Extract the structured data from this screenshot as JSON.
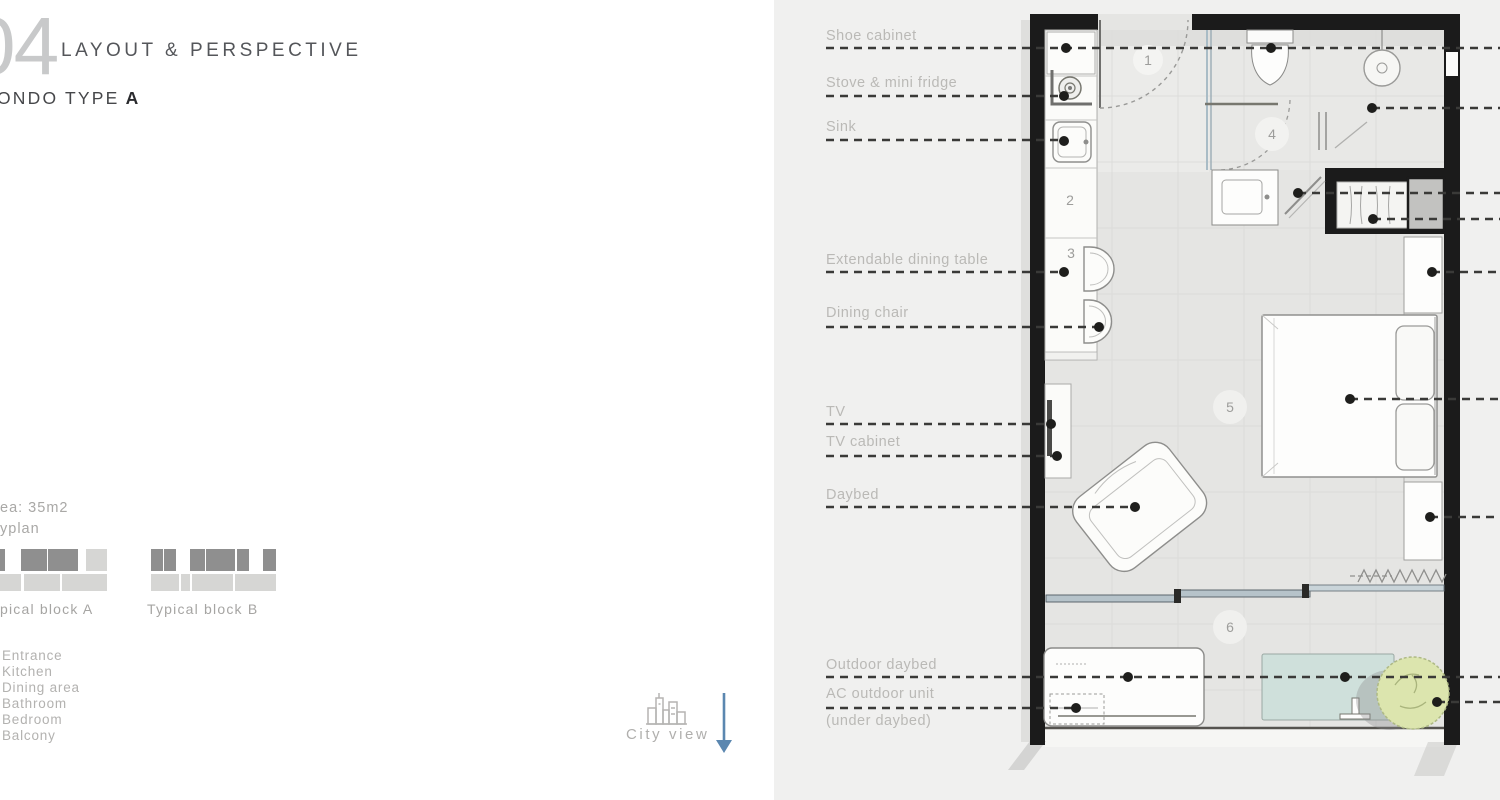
{
  "header": {
    "page_number": "04",
    "section_title": "LAYOUT & PERSPECTIVE",
    "condo_type_prefix": "ONDO TYPE",
    "condo_type_letter": "A"
  },
  "sidebar": {
    "area_text": "ea: 35m2",
    "keyplan_text": "yplan",
    "block_a_label": "pical block A",
    "block_b_label": "Typical block B",
    "legend_items": [
      "Entrance",
      "Kitchen",
      "Dining area",
      "Bathroom",
      "Bedroom",
      "Balcony"
    ],
    "city_view_label": "City view",
    "icons": {
      "city_view": "city-skyline-icon",
      "direction": "arrow-down-icon"
    },
    "arrow_color": "#5b87b0"
  },
  "plan": {
    "rooms": [
      {
        "num": "1"
      },
      {
        "num": "2"
      },
      {
        "num": "3"
      },
      {
        "num": "4"
      },
      {
        "num": "5"
      },
      {
        "num": "6"
      }
    ],
    "labels": [
      {
        "text": "Shoe cabinet"
      },
      {
        "text": "Stove & mini fridge"
      },
      {
        "text": "Sink"
      },
      {
        "text": "Extendable dining table"
      },
      {
        "text": "Dining chair"
      },
      {
        "text": "TV"
      },
      {
        "text": "TV cabinet"
      },
      {
        "text": "Daybed"
      },
      {
        "text": "Outdoor daybed"
      },
      {
        "text": "AC outdoor unit"
      },
      {
        "text": "(under daybed)"
      }
    ],
    "colors": {
      "wall": "#1b1b1b",
      "floor": "#e5e5e3",
      "panel_background": "#f0f0ef",
      "glass_rail": "#b9c6ce",
      "outdoor_mat": "#cfe0db",
      "plant": "#dce5ae",
      "leader_line": "#3a3a38"
    }
  }
}
